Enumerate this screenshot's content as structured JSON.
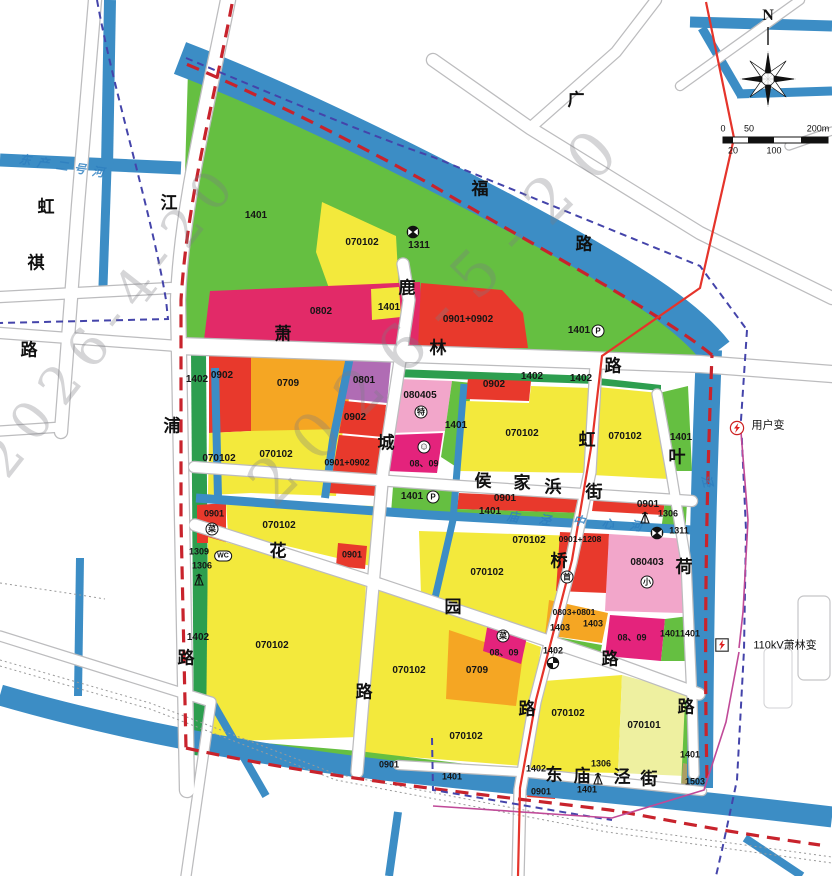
{
  "colors": {
    "river": "#3c8dc5",
    "parcel_yellow": "#f3e93c",
    "parcel_pale_yellow": "#eef0a0",
    "parcel_green": "#65bf41",
    "strip_green": "#2d9e4f",
    "parcel_red": "#e8392c",
    "parcel_magenta": "#e4237c",
    "parcel_rose": "#e22a68",
    "parcel_orange": "#f5a623",
    "parcel_pink": "#f2a6ca",
    "parcel_purple": "#b06cb4",
    "parcel_olive": "#ac9e62",
    "boundary_red_dash": "#c8232c",
    "boundary_blue_dash": "#4444aa",
    "power_line_red": "#e5342b",
    "substation_line_purple": "#c04a98",
    "road_casing": "#bcbcbe"
  },
  "watermarks": [
    {
      "text": "2026-4-20"
    },
    {
      "text": "2026-5-20"
    }
  ],
  "map": {
    "labels": [
      {
        "t": "N",
        "x": 768,
        "y": 16,
        "k": "n"
      },
      {
        "t": "0",
        "x": 723,
        "y": 129,
        "k": "s"
      },
      {
        "t": "50",
        "x": 749,
        "y": 129,
        "k": "s"
      },
      {
        "t": "200m",
        "x": 818,
        "y": 129,
        "k": "s"
      },
      {
        "t": "20",
        "x": 733,
        "y": 151,
        "k": "s"
      },
      {
        "t": "100",
        "x": 774,
        "y": 151,
        "k": "s"
      },
      {
        "t": "萧",
        "x": 283,
        "y": 334,
        "k": "r"
      },
      {
        "t": "林",
        "x": 438,
        "y": 348,
        "k": "r"
      },
      {
        "t": "路",
        "x": 613,
        "y": 366,
        "k": "r"
      },
      {
        "t": "广",
        "x": 576,
        "y": 100,
        "k": "r"
      },
      {
        "t": "福",
        "x": 480,
        "y": 189,
        "k": "r"
      },
      {
        "t": "路",
        "x": 584,
        "y": 244,
        "k": "r"
      },
      {
        "t": "江",
        "x": 169,
        "y": 203,
        "k": "r"
      },
      {
        "t": "浦",
        "x": 172,
        "y": 426,
        "k": "r"
      },
      {
        "t": "路",
        "x": 186,
        "y": 658,
        "k": "r"
      },
      {
        "t": "虹",
        "x": 46,
        "y": 207,
        "k": "r"
      },
      {
        "t": "祺",
        "x": 36,
        "y": 263,
        "k": "r"
      },
      {
        "t": "路",
        "x": 29,
        "y": 350,
        "k": "r"
      },
      {
        "t": "鹿",
        "x": 407,
        "y": 288,
        "k": "r"
      },
      {
        "t": "城",
        "x": 386,
        "y": 443,
        "k": "r"
      },
      {
        "t": "路",
        "x": 364,
        "y": 692,
        "k": "r"
      },
      {
        "t": "虹",
        "x": 587,
        "y": 440,
        "k": "r"
      },
      {
        "t": "桥",
        "x": 559,
        "y": 561,
        "k": "r"
      },
      {
        "t": "路",
        "x": 527,
        "y": 709,
        "k": "r"
      },
      {
        "t": "叶",
        "x": 677,
        "y": 457,
        "k": "r"
      },
      {
        "t": "荷",
        "x": 684,
        "y": 567,
        "k": "r"
      },
      {
        "t": "路",
        "x": 686,
        "y": 707,
        "k": "r"
      },
      {
        "t": "侯",
        "x": 483,
        "y": 481,
        "k": "r"
      },
      {
        "t": "家",
        "x": 522,
        "y": 483,
        "k": "r"
      },
      {
        "t": "浜",
        "x": 553,
        "y": 487,
        "k": "r"
      },
      {
        "t": "街",
        "x": 594,
        "y": 492,
        "k": "r"
      },
      {
        "t": "花",
        "x": 278,
        "y": 551,
        "k": "r"
      },
      {
        "t": "园",
        "x": 453,
        "y": 607,
        "k": "r"
      },
      {
        "t": "路",
        "x": 610,
        "y": 659,
        "k": "r"
      },
      {
        "t": "东",
        "x": 554,
        "y": 775,
        "k": "r"
      },
      {
        "t": "庙",
        "x": 582,
        "y": 776,
        "k": "r"
      },
      {
        "t": "泾",
        "x": 622,
        "y": 777,
        "k": "r"
      },
      {
        "t": "街",
        "x": 649,
        "y": 779,
        "k": "r"
      },
      {
        "t": "东",
        "x": 25,
        "y": 160,
        "k": "v",
        "o": 8
      },
      {
        "t": "产",
        "x": 43,
        "y": 163,
        "k": "v",
        "o": 8
      },
      {
        "t": "二",
        "x": 62,
        "y": 166,
        "k": "v",
        "o": 8
      },
      {
        "t": "号",
        "x": 80,
        "y": 169,
        "k": "v",
        "o": 8
      },
      {
        "t": "河",
        "x": 98,
        "y": 172,
        "k": "v",
        "o": 8
      },
      {
        "t": "中",
        "x": 579,
        "y": 521,
        "k": "v",
        "o": 10
      },
      {
        "t": "心",
        "x": 608,
        "y": 524,
        "k": "v",
        "o": 10
      },
      {
        "t": "河",
        "x": 636,
        "y": 526,
        "k": "v",
        "o": 10
      },
      {
        "t": "庙",
        "x": 513,
        "y": 517,
        "k": "v",
        "o": 10
      },
      {
        "t": "泾",
        "x": 545,
        "y": 520,
        "k": "v",
        "o": 10
      },
      {
        "t": "泾",
        "x": 707,
        "y": 481,
        "k": "v",
        "o": 75
      },
      {
        "t": "1401",
        "x": 256,
        "y": 216,
        "k": "c"
      },
      {
        "t": "070102",
        "x": 362,
        "y": 243,
        "k": "c"
      },
      {
        "t": "1311",
        "x": 419,
        "y": 246,
        "k": "c"
      },
      {
        "t": "0802",
        "x": 321,
        "y": 312,
        "k": "c"
      },
      {
        "t": "1401",
        "x": 389,
        "y": 308,
        "k": "c"
      },
      {
        "t": "0901+0902",
        "x": 468,
        "y": 320,
        "k": "c"
      },
      {
        "t": "1401",
        "x": 579,
        "y": 331,
        "k": "c"
      },
      {
        "t": "1402",
        "x": 197,
        "y": 380,
        "k": "c"
      },
      {
        "t": "0902",
        "x": 222,
        "y": 376,
        "k": "c"
      },
      {
        "t": "0709",
        "x": 288,
        "y": 384,
        "k": "c"
      },
      {
        "t": "0801",
        "x": 364,
        "y": 381,
        "k": "c"
      },
      {
        "t": "0902",
        "x": 355,
        "y": 418,
        "k": "c"
      },
      {
        "t": "0901+0902",
        "x": 347,
        "y": 463,
        "k": "c",
        "s": 9
      },
      {
        "t": "070102",
        "x": 219,
        "y": 459,
        "k": "c"
      },
      {
        "t": "070102",
        "x": 276,
        "y": 455,
        "k": "c"
      },
      {
        "t": "080405",
        "x": 420,
        "y": 396,
        "k": "c"
      },
      {
        "t": "1401",
        "x": 456,
        "y": 426,
        "k": "c"
      },
      {
        "t": "08、09",
        "x": 424,
        "y": 464,
        "k": "c",
        "s": 9
      },
      {
        "t": "0902",
        "x": 494,
        "y": 385,
        "k": "c"
      },
      {
        "t": "1402",
        "x": 532,
        "y": 377,
        "k": "c"
      },
      {
        "t": "1402",
        "x": 581,
        "y": 379,
        "k": "c"
      },
      {
        "t": "070102",
        "x": 522,
        "y": 434,
        "k": "c"
      },
      {
        "t": "070102",
        "x": 625,
        "y": 437,
        "k": "c"
      },
      {
        "t": "1401",
        "x": 681,
        "y": 438,
        "k": "c"
      },
      {
        "t": "1401",
        "x": 412,
        "y": 497,
        "k": "c"
      },
      {
        "t": "0901",
        "x": 505,
        "y": 499,
        "k": "c"
      },
      {
        "t": "1401",
        "x": 490,
        "y": 512,
        "k": "c"
      },
      {
        "t": "0901",
        "x": 648,
        "y": 505,
        "k": "c"
      },
      {
        "t": "1306",
        "x": 668,
        "y": 514,
        "k": "c",
        "s": 9
      },
      {
        "t": "1311",
        "x": 679,
        "y": 531,
        "k": "c",
        "s": 9
      },
      {
        "t": "0901",
        "x": 214,
        "y": 514,
        "k": "c",
        "s": 9
      },
      {
        "t": "1309",
        "x": 199,
        "y": 552,
        "k": "c",
        "s": 9
      },
      {
        "t": "1306",
        "x": 202,
        "y": 566,
        "k": "c",
        "s": 9
      },
      {
        "t": "070102",
        "x": 279,
        "y": 526,
        "k": "c"
      },
      {
        "t": "0901",
        "x": 352,
        "y": 555,
        "k": "c",
        "s": 9
      },
      {
        "t": "070102",
        "x": 529,
        "y": 541,
        "k": "c"
      },
      {
        "t": "070102",
        "x": 487,
        "y": 573,
        "k": "c"
      },
      {
        "t": "0901+1208",
        "x": 580,
        "y": 539,
        "k": "c",
        "s": 8.5
      },
      {
        "t": "080403",
        "x": 647,
        "y": 563,
        "k": "c"
      },
      {
        "t": "0803+0801",
        "x": 574,
        "y": 612,
        "k": "c",
        "s": 8.5
      },
      {
        "t": "1403",
        "x": 560,
        "y": 628,
        "k": "c",
        "s": 9
      },
      {
        "t": "1403",
        "x": 593,
        "y": 624,
        "k": "c",
        "s": 9
      },
      {
        "t": "08、09",
        "x": 632,
        "y": 638,
        "k": "c",
        "s": 9
      },
      {
        "t": "1401",
        "x": 670,
        "y": 634,
        "k": "c",
        "s": 9
      },
      {
        "t": "1401",
        "x": 690,
        "y": 634,
        "k": "c",
        "s": 9
      },
      {
        "t": "1402",
        "x": 553,
        "y": 651,
        "k": "c",
        "s": 9
      },
      {
        "t": "1402",
        "x": 198,
        "y": 638,
        "k": "c"
      },
      {
        "t": "070102",
        "x": 272,
        "y": 646,
        "k": "c"
      },
      {
        "t": "070102",
        "x": 409,
        "y": 671,
        "k": "c"
      },
      {
        "t": "0709",
        "x": 477,
        "y": 671,
        "k": "c"
      },
      {
        "t": "08、09",
        "x": 504,
        "y": 653,
        "k": "c",
        "s": 9
      },
      {
        "t": "070102",
        "x": 466,
        "y": 737,
        "k": "c"
      },
      {
        "t": "0901",
        "x": 389,
        "y": 765,
        "k": "c",
        "s": 9
      },
      {
        "t": "070102",
        "x": 568,
        "y": 714,
        "k": "c"
      },
      {
        "t": "070101",
        "x": 644,
        "y": 726,
        "k": "c"
      },
      {
        "t": "1401",
        "x": 690,
        "y": 755,
        "k": "c",
        "s": 9
      },
      {
        "t": "1503",
        "x": 695,
        "y": 782,
        "k": "c",
        "s": 9
      },
      {
        "t": "1402",
        "x": 536,
        "y": 769,
        "k": "c",
        "s": 9
      },
      {
        "t": "1306",
        "x": 601,
        "y": 764,
        "k": "c",
        "s": 9
      },
      {
        "t": "1401",
        "x": 452,
        "y": 777,
        "k": "c",
        "s": 9
      },
      {
        "t": "0901",
        "x": 541,
        "y": 792,
        "k": "c",
        "s": 9
      },
      {
        "t": "1401",
        "x": 587,
        "y": 790,
        "k": "c",
        "s": 9
      },
      {
        "t": "用户变",
        "x": 768,
        "y": 426,
        "k": "p"
      },
      {
        "t": "110kV萧林变",
        "x": 785,
        "y": 646,
        "k": "p"
      }
    ],
    "icons": [
      {
        "type": "circle",
        "ch": "特",
        "x": 421,
        "y": 412,
        "name": "special-use-icon"
      },
      {
        "type": "circle",
        "ch": "☺",
        "x": 424,
        "y": 447,
        "name": "kindergarten-icon",
        "face": true
      },
      {
        "type": "circle",
        "ch": "菜",
        "x": 212,
        "y": 529,
        "name": "market-icon"
      },
      {
        "type": "circle",
        "ch": "菜",
        "x": 503,
        "y": 636,
        "name": "market-icon"
      },
      {
        "type": "circle",
        "ch": "P",
        "x": 598,
        "y": 331,
        "name": "parking-icon"
      },
      {
        "type": "circle",
        "ch": "P",
        "x": 433,
        "y": 497,
        "name": "parking-icon"
      },
      {
        "type": "wc",
        "ch": "WC",
        "x": 223,
        "y": 556,
        "name": "toilet-icon"
      },
      {
        "type": "circle",
        "ch": "首",
        "x": 567,
        "y": 577,
        "name": "shou-icon"
      },
      {
        "type": "circle",
        "ch": "小",
        "x": 647,
        "y": 582,
        "name": "primary-school-icon"
      },
      {
        "type": "bowtie",
        "x": 413,
        "y": 232,
        "name": "bridge-icon"
      },
      {
        "type": "bowtie",
        "x": 657,
        "y": 533,
        "name": "bridge-icon"
      },
      {
        "type": "quarter",
        "x": 553,
        "y": 663,
        "name": "gas-station-icon"
      },
      {
        "type": "tower",
        "x": 199,
        "y": 579,
        "name": "telecom-tower-icon"
      },
      {
        "type": "tower",
        "x": 645,
        "y": 517,
        "name": "telecom-tower-icon"
      },
      {
        "type": "tower",
        "x": 598,
        "y": 778,
        "name": "telecom-tower-icon"
      },
      {
        "type": "boltc",
        "x": 737,
        "y": 428,
        "name": "user-transformer-icon"
      },
      {
        "type": "bolts",
        "x": 722,
        "y": 645,
        "name": "substation-icon"
      }
    ]
  }
}
